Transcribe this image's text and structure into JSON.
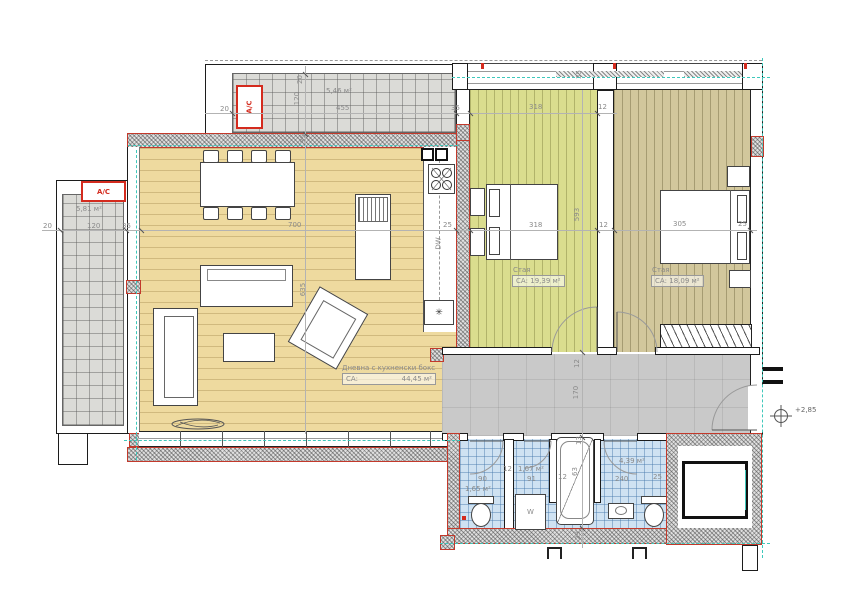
{
  "rooms": {
    "living": {
      "name": "Дневна с кухненски бокс",
      "area_label": "СА:",
      "area": "44,45 м²"
    },
    "bedroom1": {
      "name": "Стая",
      "area": "СА: 19,39 м²"
    },
    "bedroom2": {
      "name": "Стая",
      "area": "СА: 18,09 м²"
    },
    "balcony_top": {
      "area": "5,46 м²"
    },
    "balcony_left": {
      "area": "5,81 м²"
    },
    "wc": {
      "area": "1,65 м²"
    },
    "laundry": {
      "area": "1,67 м²"
    },
    "bathroom": {
      "area": "4,39 м²"
    }
  },
  "equipment": {
    "ac": "A/C",
    "washer": "W",
    "dishwasher": "DW",
    "fridge": "✳"
  },
  "level_marker": "+2,85",
  "dims": {
    "balcony_top_width": "455",
    "balcony_top_depth": "120",
    "balcony_top_rail": "20",
    "balcony_top_left": "20",
    "balcony_top_gap": "35",
    "balcony_top_wall": "35",
    "balcony_left_width": "120",
    "balcony_left_rail": "20",
    "balcony_left_gap": "35",
    "living_width": "700",
    "living_height": "635",
    "kitchen_depth": "25",
    "bed1_width": "318",
    "bed1_height": "593",
    "wall_12": "12",
    "bed1_win_width": "318",
    "bed1_win_wall": "12",
    "win_band": "35",
    "bed2_width": "305",
    "bed2_wall": "25",
    "corridor_wall": "12",
    "corridor_width": "170",
    "wc_width": "90",
    "laundry_width": "91",
    "laundry_wall_left": "12",
    "tub_wall": "12",
    "tub_top": "13",
    "tub_width": "63",
    "bath_width": "240",
    "bath_wall": "25",
    "bottom_wall": "29"
  },
  "colors": {
    "wall_red": "#d42b1e",
    "axis_teal": "#3ec8bb",
    "living_floor": "#eeda9f",
    "bedroom1_floor": "#dadd8e",
    "bedroom2_floor": "#d2c79c",
    "bath_tile": "#cfe2f2",
    "corridor": "#c9c9c9"
  }
}
